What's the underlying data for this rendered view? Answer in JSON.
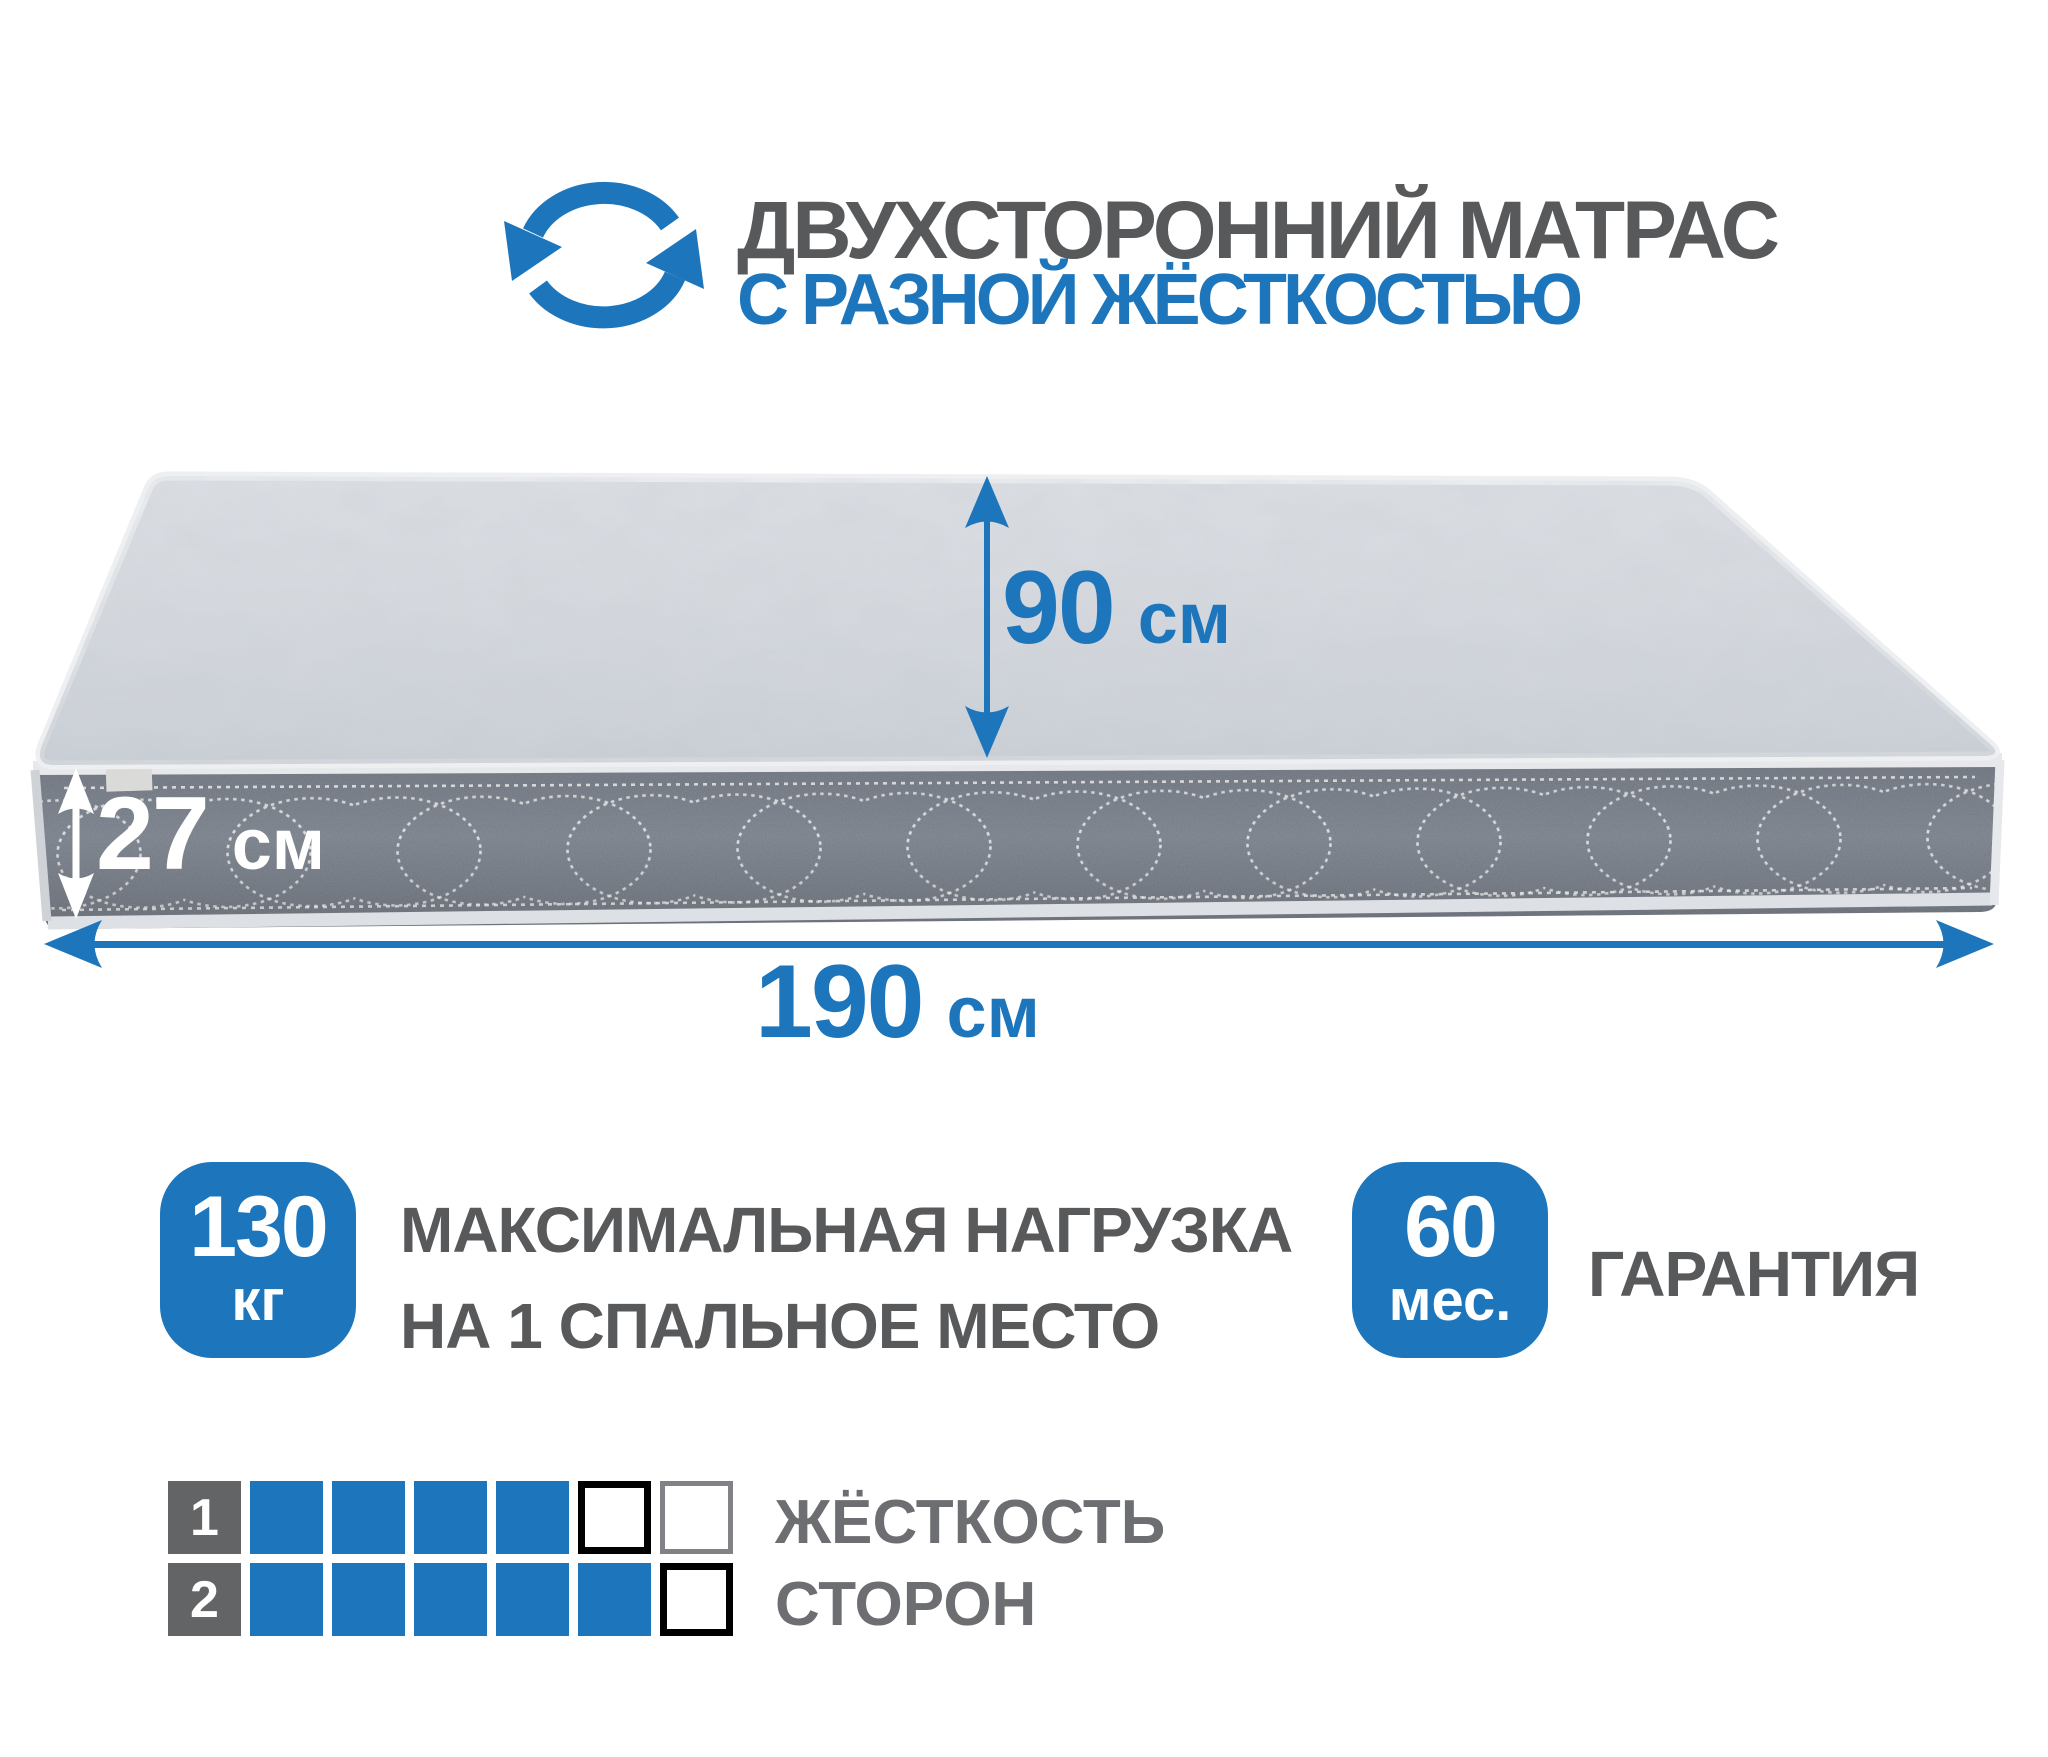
{
  "header": {
    "title": "ДВУХСТОРОННИЙ МАТРАС",
    "subtitle": "С РАЗНОЙ ЖЁСТКОСТЬЮ"
  },
  "dimensions": {
    "bed_width": {
      "value": "90",
      "unit": "см"
    },
    "height": {
      "value": "27",
      "unit": "см"
    },
    "length": {
      "value": "190",
      "unit": "см"
    }
  },
  "badges": {
    "max_load": {
      "value": "130",
      "unit": "кг",
      "label_line1": "МАКСИМАЛЬНАЯ НАГРУЗКА",
      "label_line2": "НА 1 СПАЛЬНОЕ МЕСТО"
    },
    "warranty": {
      "value": "60",
      "unit": "мес.",
      "label": "ГАРАНТИЯ"
    }
  },
  "firmness": {
    "label_line1": "ЖЁСТКОСТЬ",
    "label_line2": "СТОРОН",
    "rows": [
      {
        "side": "1",
        "cells": [
          "filled",
          "filled",
          "filled",
          "filled",
          "empty-strong",
          "empty-light"
        ]
      },
      {
        "side": "2",
        "cells": [
          "filled",
          "filled",
          "filled",
          "filled",
          "filled",
          "empty-strong"
        ]
      }
    ]
  },
  "icons": {
    "rotate": "rotate-arrows-icon"
  },
  "colors": {
    "accent_blue": "#1d76bc",
    "text_gray": "#58595b",
    "label_gray": "#6d6e71",
    "fabric_gray": "#d5d9de",
    "band_gray": "#747b86",
    "square_dark": "#636466",
    "empty_border_strong": "#000000",
    "empty_border_light": "#808285",
    "piping_light": "#e6e8eb"
  }
}
